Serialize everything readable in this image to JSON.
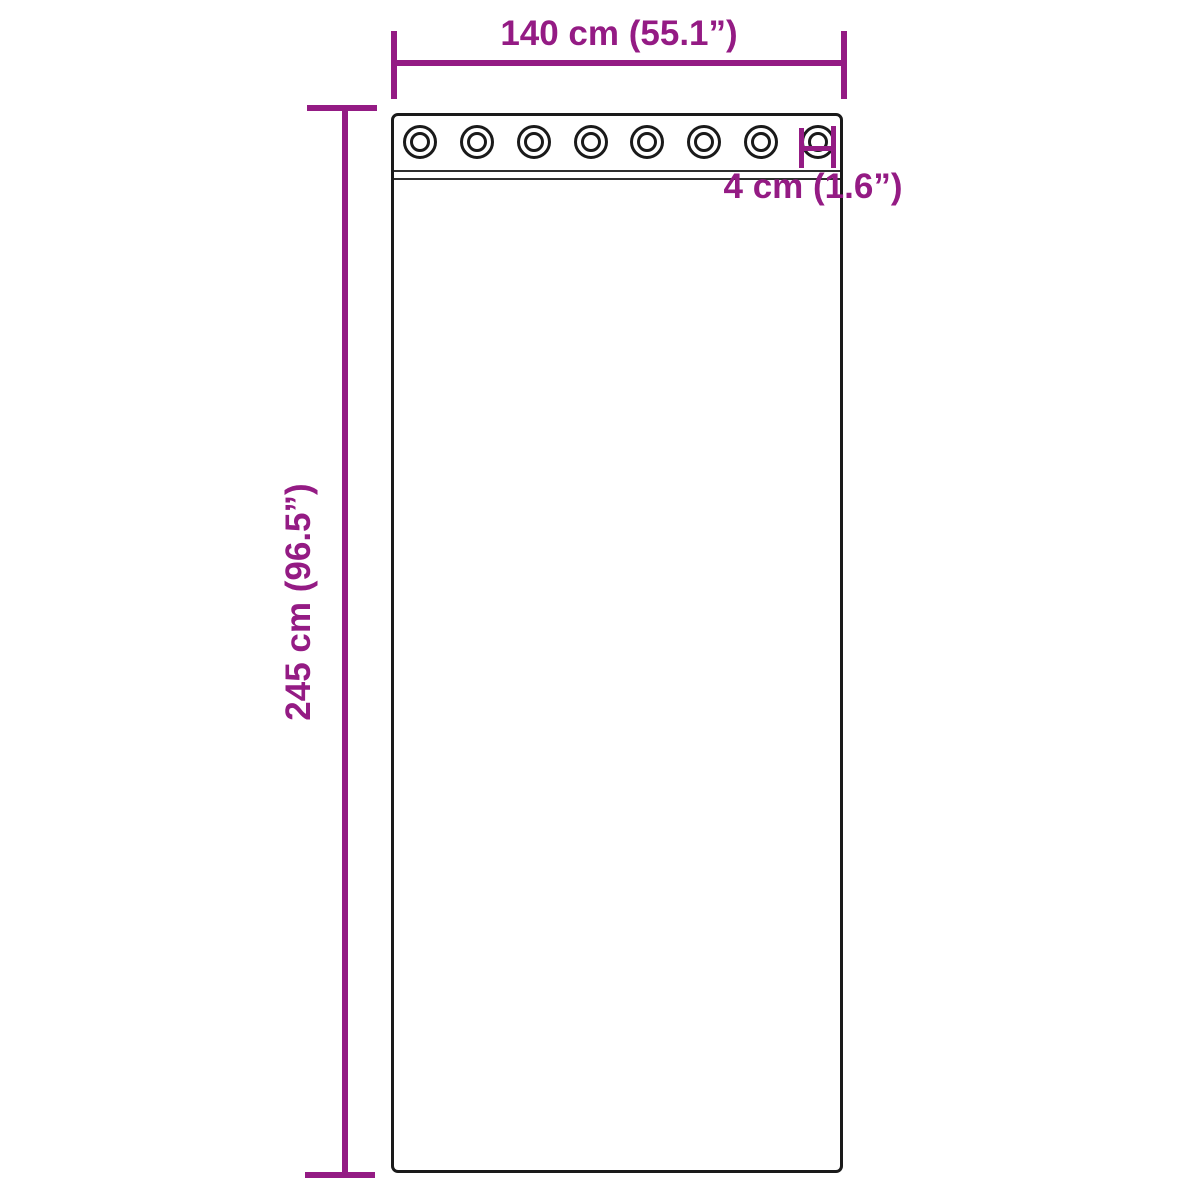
{
  "diagram": {
    "dimensions": {
      "width_label": "140 cm (55.1”)",
      "height_label": "245 cm (96.5”)",
      "grommet_label": "4 cm (1.6”)"
    },
    "grommet_count": 8,
    "colors": {
      "dimension": "#941b84",
      "outline": "#1a1a1a",
      "background": "#ffffff"
    }
  }
}
